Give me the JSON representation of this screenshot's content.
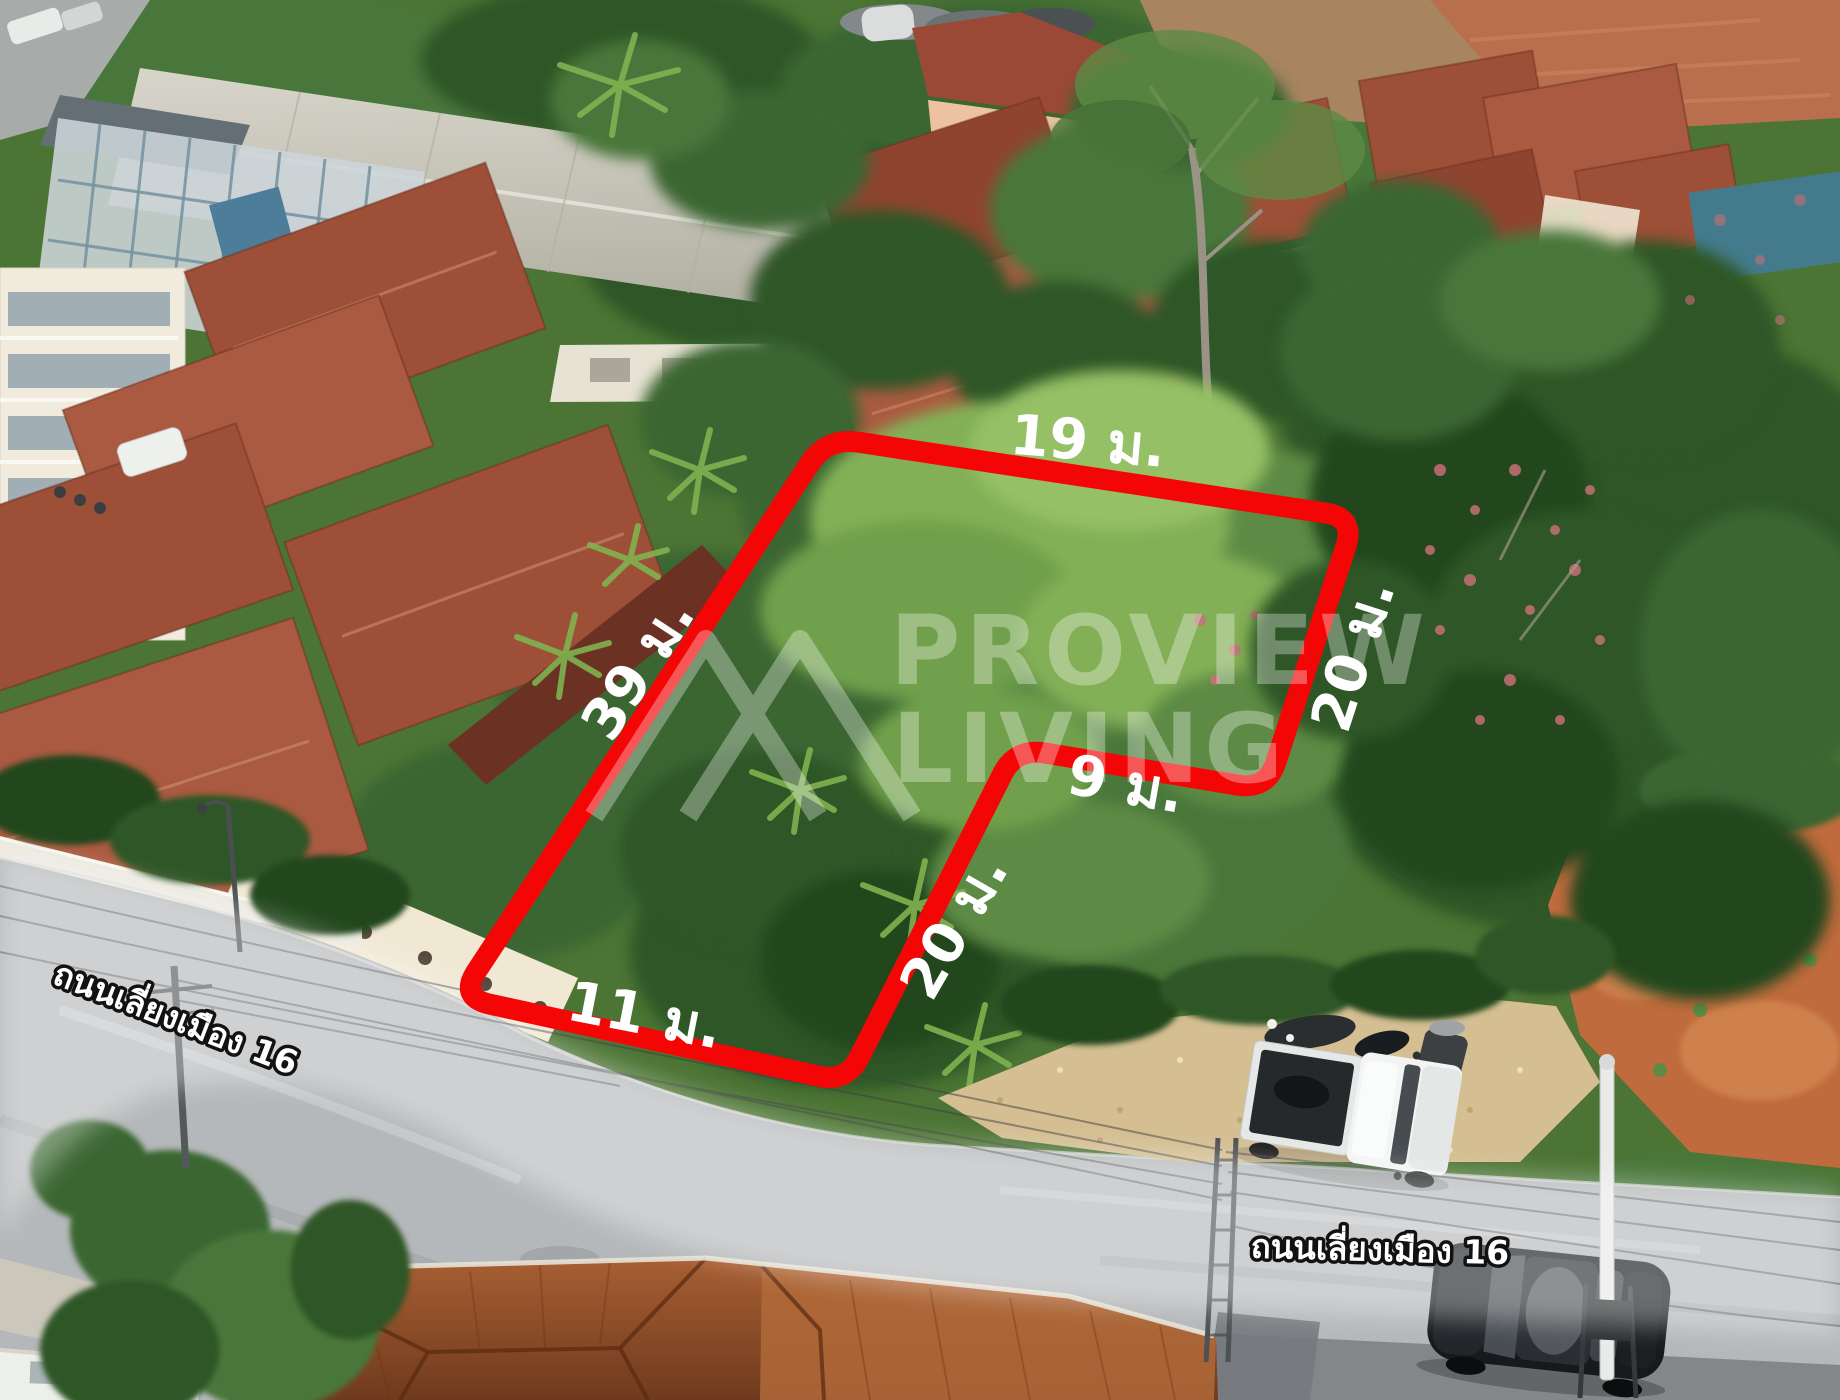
{
  "plot": {
    "boundary_color": "#f40606",
    "dimension_labels": {
      "top": "19 ม.",
      "right": "20 ม.",
      "notch": "9 ม.",
      "inner": "20 ม.",
      "left": "39 ม.",
      "bottom": "11 ม."
    }
  },
  "roads": {
    "left_label": "ถนนเลี่ยงเมือง 16",
    "bottom_label": "ถนนเลี่ยงเมือง 16"
  },
  "watermark": {
    "line1": "PROVIEW",
    "line2": "LIVING"
  }
}
